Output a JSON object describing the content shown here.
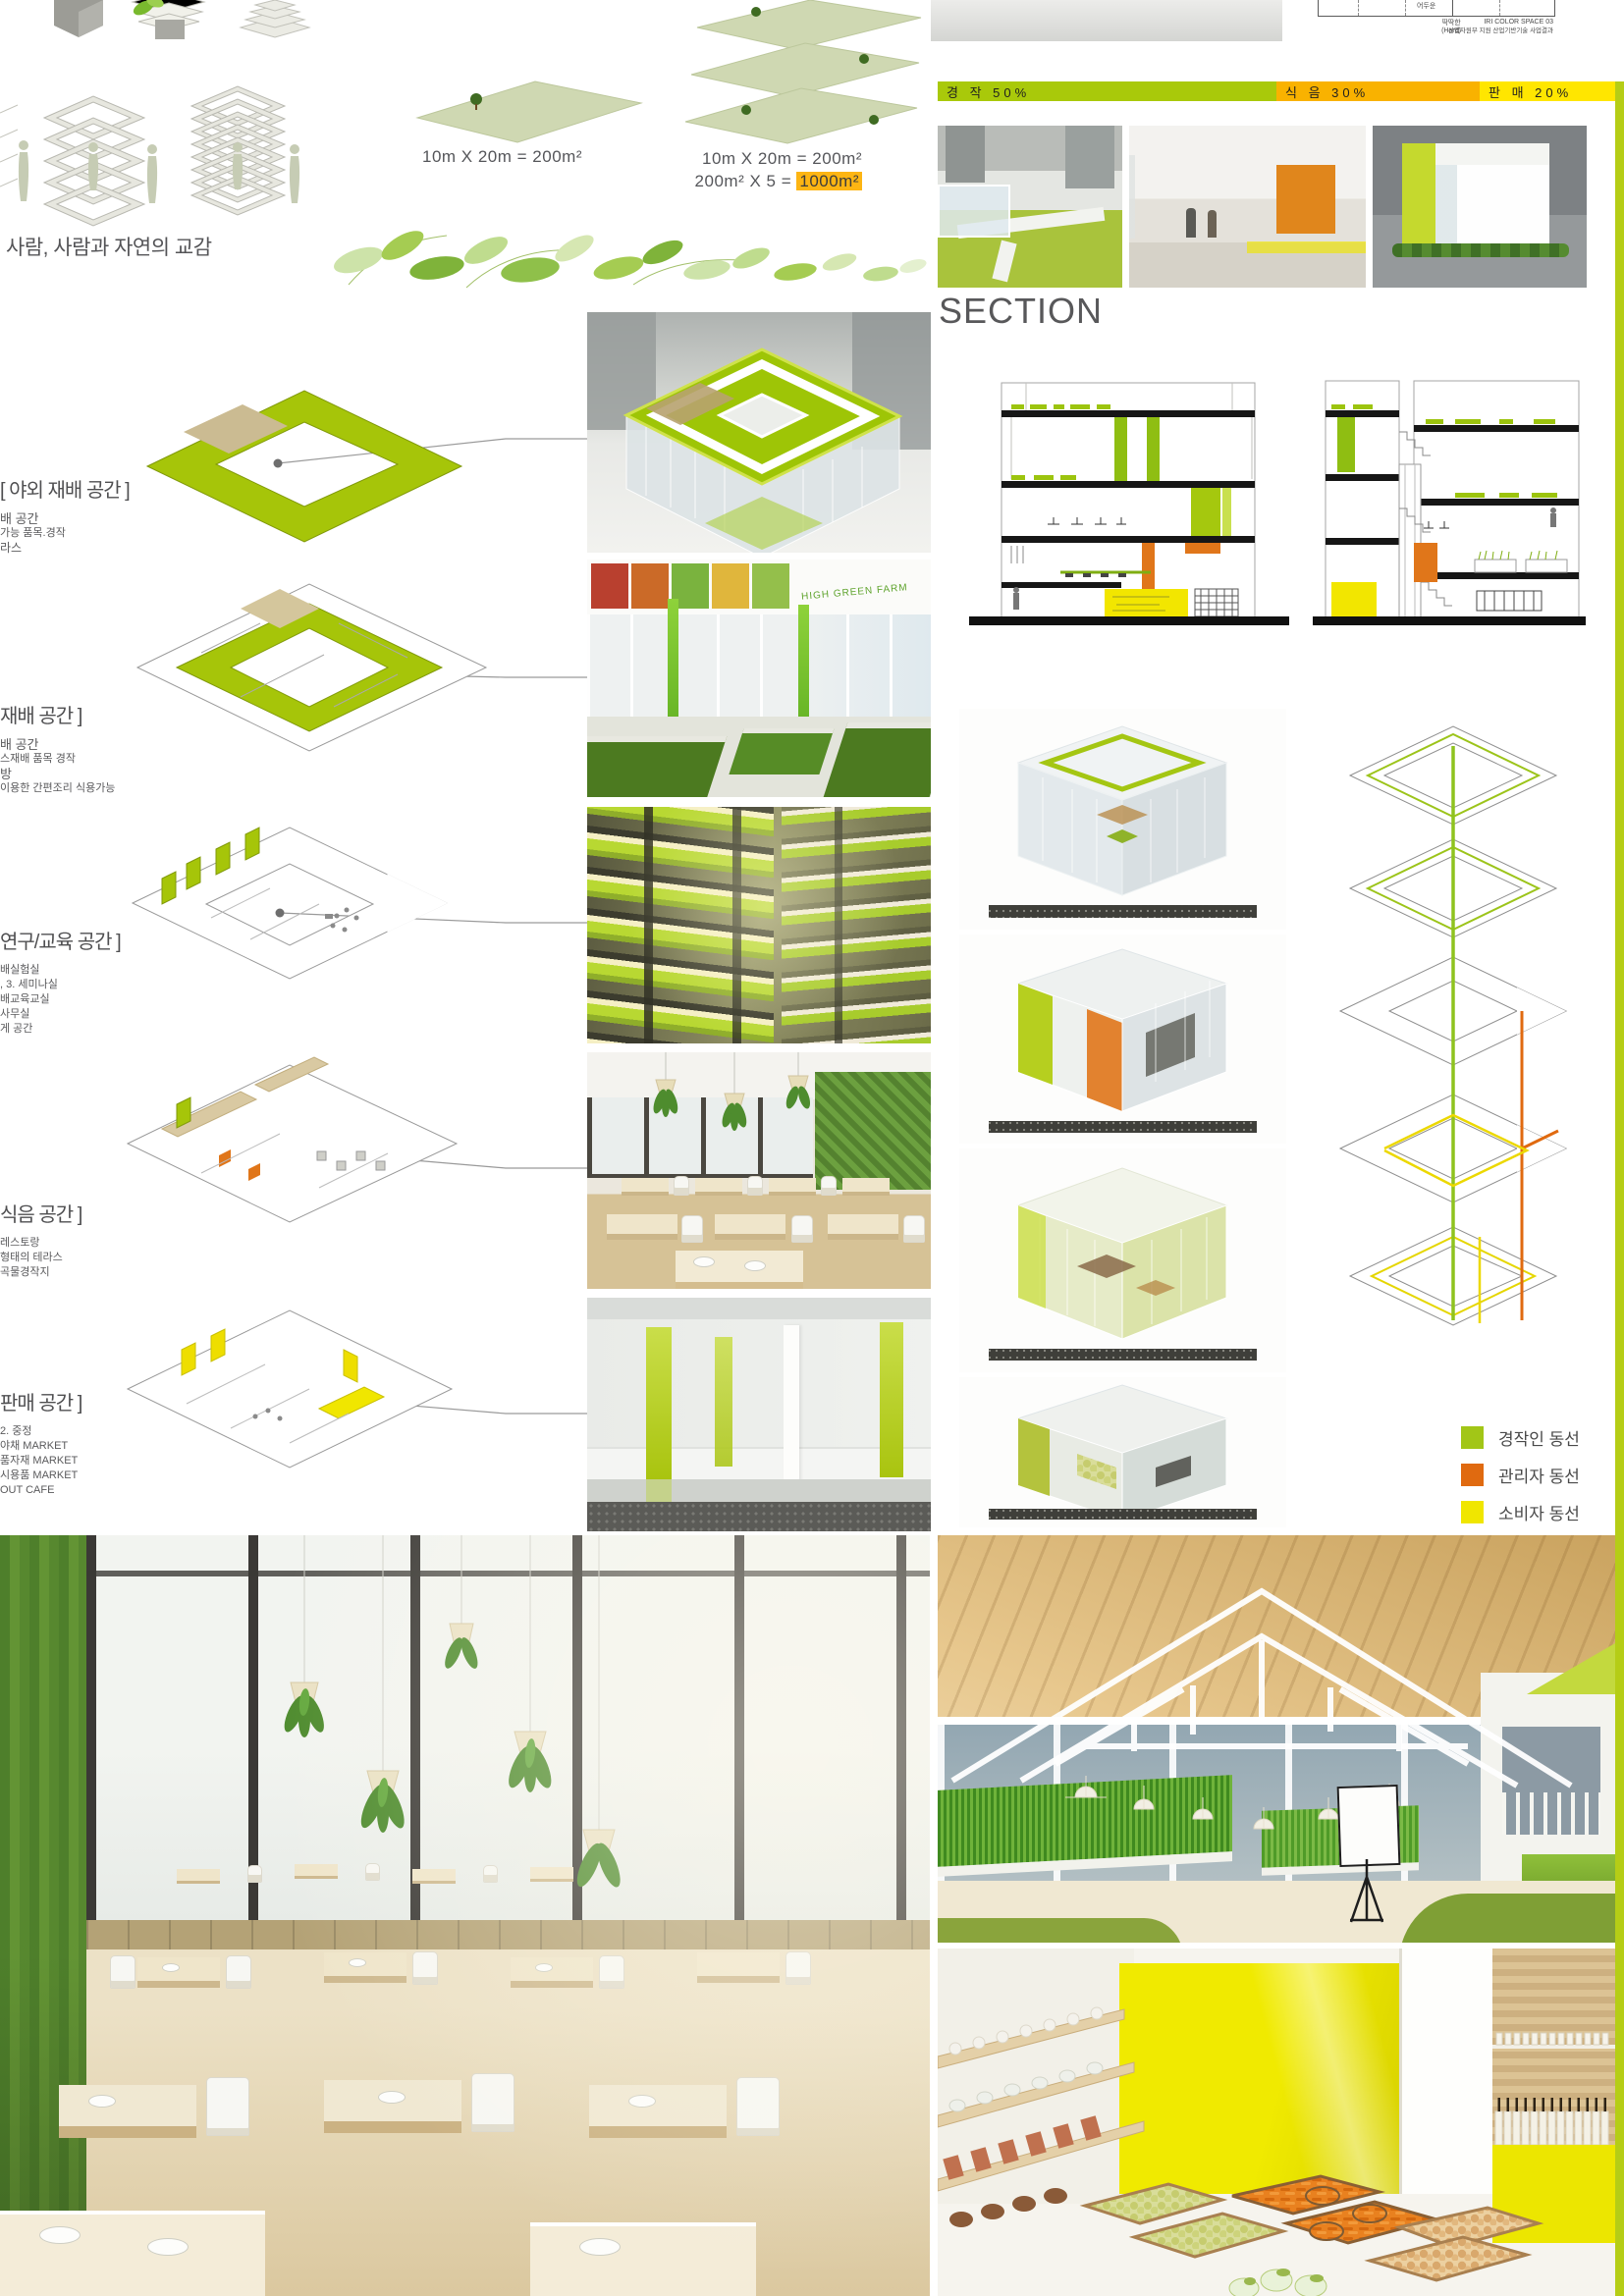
{
  "header": {
    "concept_text": "사람, 사람과 자연의 교감",
    "area_left_label": "10m X 20m = 200m²",
    "area_right_line1": "10m X 20m = 200m²",
    "area_right_line2_prefix": "200m²  X  5 = ",
    "area_right_line2_value": "1000m²"
  },
  "iri_diagram": {
    "cell_label": "어두운",
    "axis_label": "딱딱한",
    "axis_label_sub": "(Hard)",
    "series_title": "IRI COLOR SPACE 03",
    "credit_line": "산업자원부 지원 산업기반기술 사업결과"
  },
  "program_bar": {
    "segments": [
      {
        "label": "경 작 50%",
        "value": 50,
        "color": "#a9c90a"
      },
      {
        "label": "식 음 30%",
        "value": 30,
        "color": "#f9b200"
      },
      {
        "label": "판 매 20%",
        "value": 20,
        "color": "#ffe600"
      }
    ]
  },
  "chart_data": {
    "type": "bar",
    "categories": [
      "경작",
      "식음",
      "판매"
    ],
    "values": [
      50,
      30,
      20
    ],
    "unit": "%",
    "layout": "horizontal-stacked-100percent",
    "colors": [
      "#a9c90a",
      "#f9b200",
      "#ffe600"
    ]
  },
  "section_heading": "SECTION",
  "floor_spaces": [
    {
      "title": "[ 야외 재배 공간 ]",
      "lines": [
        "배 공간",
        "가능 품목.경작",
        "라스"
      ]
    },
    {
      "title": "재배 공간 ]",
      "lines": [
        "배 공간",
        "스재배 품목 경작",
        "방",
        "이용한 간편조리 식용가능"
      ]
    },
    {
      "title": "연구/교육 공간 ]",
      "lines": [
        "배실험실",
        ", 3. 세미나실",
        "배교육교실",
        "사무실",
        "게 공간"
      ]
    },
    {
      "title": "식음 공간 ]",
      "lines": [
        "레스토랑",
        "형태의 테라스",
        "곡물경작지"
      ]
    },
    {
      "title": "판매 공간 ]",
      "lines": [
        "2. 중정",
        "야채 MARKET",
        "품자재 MARKET",
        "시용품 MARKET",
        "OUT CAFE"
      ]
    }
  ],
  "photo_captions": {
    "farm_banner": "HIGH GREEN FARM"
  },
  "legend": {
    "items": [
      {
        "label": "경작인 동선",
        "color": "#a2c617"
      },
      {
        "label": "관리자 동선",
        "color": "#e06a10"
      },
      {
        "label": "소비자 동선",
        "color": "#f0e600"
      }
    ]
  },
  "colors": {
    "lime": "#aac800",
    "plate_green": "#cfd8b2",
    "amber": "#f9b200",
    "yellow": "#f0e600",
    "orange": "#e06a10",
    "highlight": "#fdb513"
  }
}
